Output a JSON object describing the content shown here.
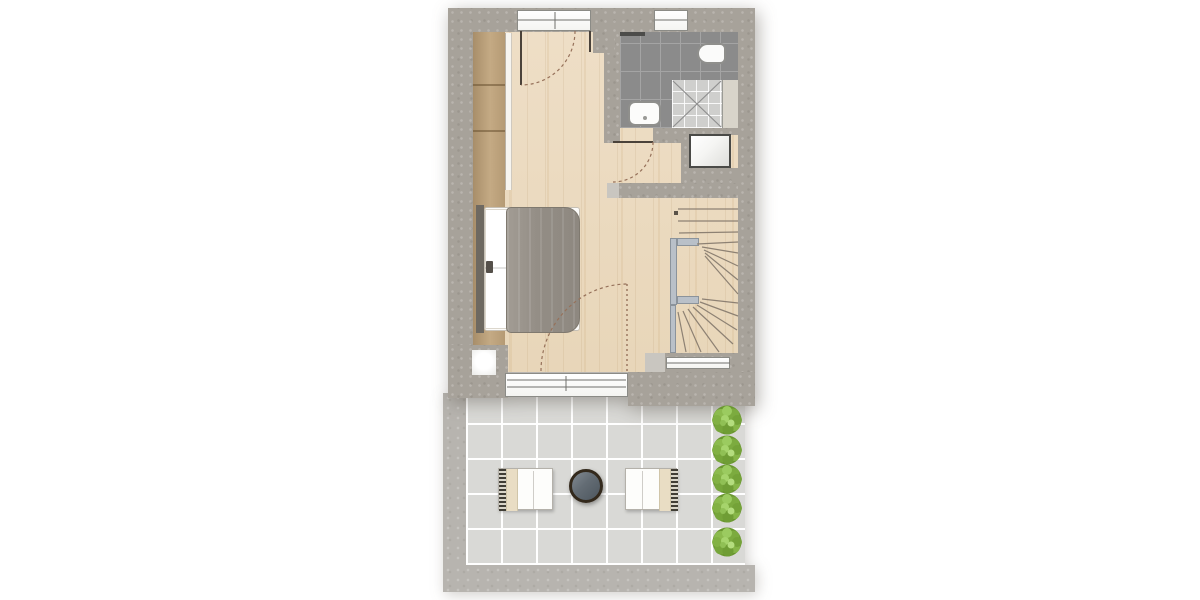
{
  "meta": {
    "description": "Residential floor plan, upper level: bedroom with wardrobe and double bed, bathroom with shower / toilet / washbasin, hallway with glass shaft, winder staircase, and a tiled terrace below with two loungers, a round patio table and a row of five shrubs.",
    "canvas": {
      "width": 1200,
      "height": 600
    }
  },
  "palette": {
    "wall": "#a7a29a",
    "wall-light": "#c9c6c0",
    "t-wall": "#b7b4af",
    "wood": "#eedec6",
    "bath-tile": "#8b8b8b",
    "bath-grout": "#a4a4a4",
    "shower-tile": "#cfcfcd",
    "terrace-tile": "#d9d9d6",
    "tan": "#c4aa84",
    "duvet": "#938d85",
    "cream": "#e9ddc4",
    "rail": "#b9c0c8",
    "rail-border": "#8b939b",
    "tread": "#8d8173",
    "arc": "#96715a",
    "leaf": "#4a423a",
    "glaze": "#70706c",
    "shower-line": "#8f8f8f",
    "bush-base": "#69962f"
  },
  "rooms": [
    {
      "id": "bedroom",
      "floor": "wood"
    },
    {
      "id": "bathroom",
      "floor": "dark-tile"
    },
    {
      "id": "hallway",
      "floor": "wood"
    },
    {
      "id": "staircase",
      "floor": "wood"
    },
    {
      "id": "terrace",
      "floor": "light-tile"
    }
  ],
  "objects": [
    "wardrobe",
    "double-bed",
    "shower",
    "toilet",
    "washbasin",
    "radiator-shelf",
    "glass-shaft",
    "winder-stair",
    "stair-railing",
    "lounge-chair-left",
    "lounge-chair-right",
    "patio-table",
    "shrub-row"
  ],
  "stairs": {
    "tread_color_key": "tread",
    "dot": [
      674,
      211,
      4,
      4
    ],
    "treads": [
      [
        678,
        209,
        738,
        209
      ],
      [
        678,
        221,
        738,
        221
      ],
      [
        679,
        233,
        738,
        232
      ],
      [
        697,
        244,
        738,
        242
      ],
      [
        702,
        247,
        738,
        253
      ],
      [
        704,
        250,
        738,
        266
      ],
      [
        705,
        253,
        738,
        280
      ],
      [
        705,
        256,
        738,
        294
      ],
      [
        702,
        299,
        738,
        303
      ],
      [
        700,
        302,
        738,
        316
      ],
      [
        697,
        305,
        737,
        330
      ],
      [
        693,
        307,
        733,
        344
      ],
      [
        688,
        309,
        719,
        352
      ],
      [
        683,
        311,
        701,
        352
      ],
      [
        678,
        312,
        686,
        352
      ]
    ]
  },
  "doors": {
    "entry": {
      "leaf": [
        521,
        31,
        521,
        85
      ],
      "jamb": [
        590,
        31,
        590,
        52
      ],
      "arc": "M575 31 A54 54 0 0 1 521 85"
    },
    "bath": {
      "leaf": [
        613,
        142,
        653,
        142
      ],
      "arc": "M653 142 A40 40 0 0 1 613 182"
    },
    "terrace": {
      "leaf_dotted": [
        627,
        284,
        627,
        371
      ],
      "arc": "M541 371 A87 87 0 0 1 628 284"
    }
  },
  "glazing_lines": [
    [
      518,
      20,
      590,
      20
    ],
    [
      555,
      12,
      555,
      29
    ],
    [
      655,
      20,
      687,
      20
    ],
    [
      507,
      380,
      626,
      380
    ],
    [
      507,
      387,
      626,
      387
    ],
    [
      566,
      376,
      566,
      391
    ],
    [
      667,
      363,
      730,
      363
    ]
  ],
  "shower_cross": [
    [
      673,
      81,
      721,
      127
    ],
    [
      721,
      81,
      673,
      127
    ]
  ],
  "terrace": {
    "tile_px": 35,
    "bushes": {
      "cx": 727,
      "cys": [
        420,
        450,
        479,
        508,
        542
      ],
      "r": 15
    }
  }
}
